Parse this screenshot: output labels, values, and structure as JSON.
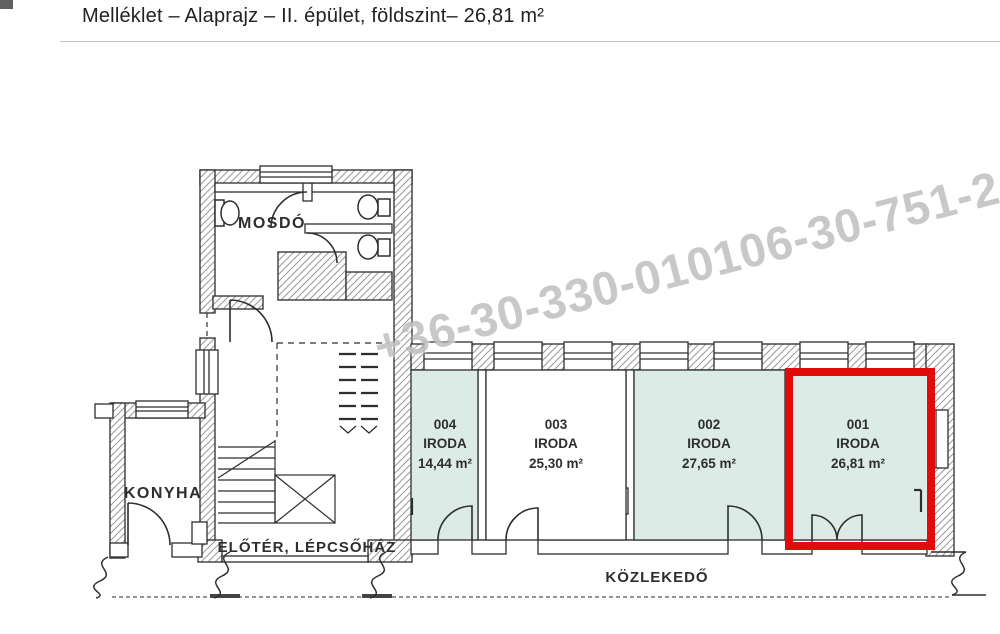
{
  "page": {
    "title": "Melléklet – Alaprajz – II. épület, földszint– 26,81 m²"
  },
  "watermark": {
    "text": "+36-30-330-010106-30-751-2"
  },
  "floorplan": {
    "labels": {
      "washroom": "MOSDÓ",
      "kitchen": "KONYHA",
      "foyer": "ELŐTÉR, LÉPCSŐHÁZ",
      "corridor": "KÖZLEKEDŐ"
    },
    "rooms": [
      {
        "number": "004",
        "type": "IRODA",
        "area": "14,44 m²",
        "highlighted": false
      },
      {
        "number": "003",
        "type": "IRODA",
        "area": "25,30 m²",
        "highlighted": false
      },
      {
        "number": "002",
        "type": "IRODA",
        "area": "27,65 m²",
        "highlighted": false
      },
      {
        "number": "001",
        "type": "IRODA",
        "area": "26,81 m²",
        "highlighted": true
      }
    ],
    "colors": {
      "room_fill": "#dcebe6",
      "highlight_border": "#e10b0b",
      "line": "#2e2e2e",
      "hatch": "#9b9b9b"
    }
  }
}
